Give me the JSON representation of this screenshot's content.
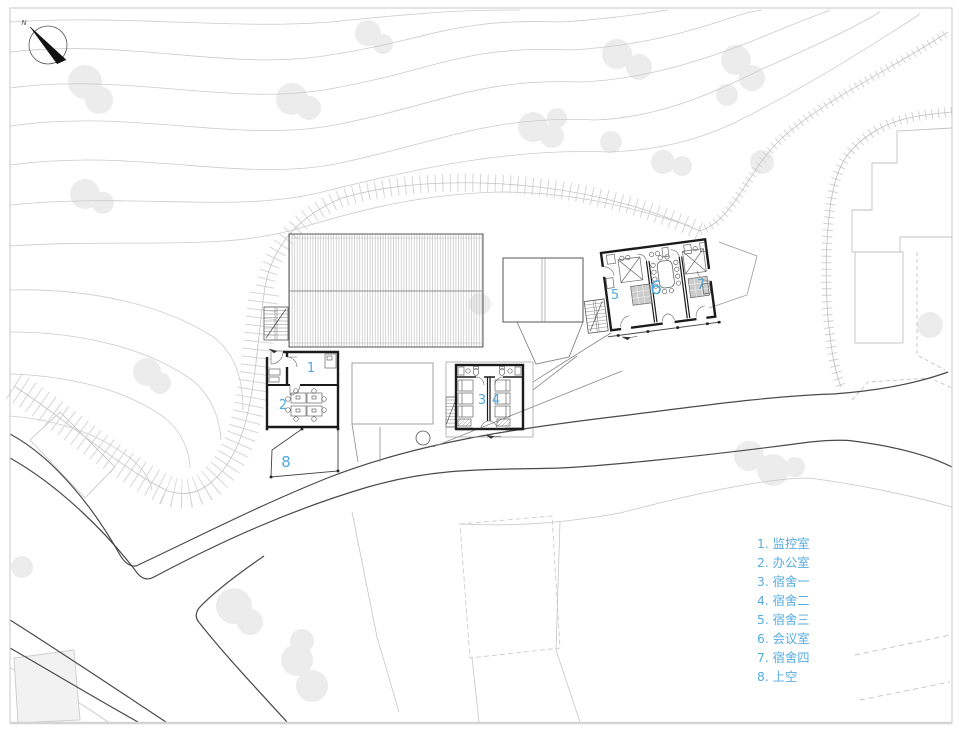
{
  "north": {
    "label": "N"
  },
  "rooms": [
    {
      "num": "1",
      "name": "监控室"
    },
    {
      "num": "2",
      "name": "办公室"
    },
    {
      "num": "3",
      "name": "宿舍一"
    },
    {
      "num": "4",
      "name": "宿舍二"
    },
    {
      "num": "5",
      "name": "宿舍三"
    },
    {
      "num": "6",
      "name": "会议室"
    },
    {
      "num": "7",
      "name": "宿舍四"
    },
    {
      "num": "8",
      "name": "上空"
    }
  ],
  "legend": {
    "items": [
      {
        "text": "1. 监控室"
      },
      {
        "text": "2. 办公室"
      },
      {
        "text": "3. 宿舍一"
      },
      {
        "text": "4. 宿舍二"
      },
      {
        "text": "5. 宿舍三"
      },
      {
        "text": "6. 会议室"
      },
      {
        "text": "7. 宿舍四"
      },
      {
        "text": "8. 上空"
      }
    ]
  },
  "colors": {
    "label_blue": "#4FA9DD",
    "legend_blue": "#57ACDF",
    "wall": "#1b1b1b",
    "road": "#4a4a4a",
    "contour": "#cbcbcb",
    "tree": "#ececec"
  }
}
